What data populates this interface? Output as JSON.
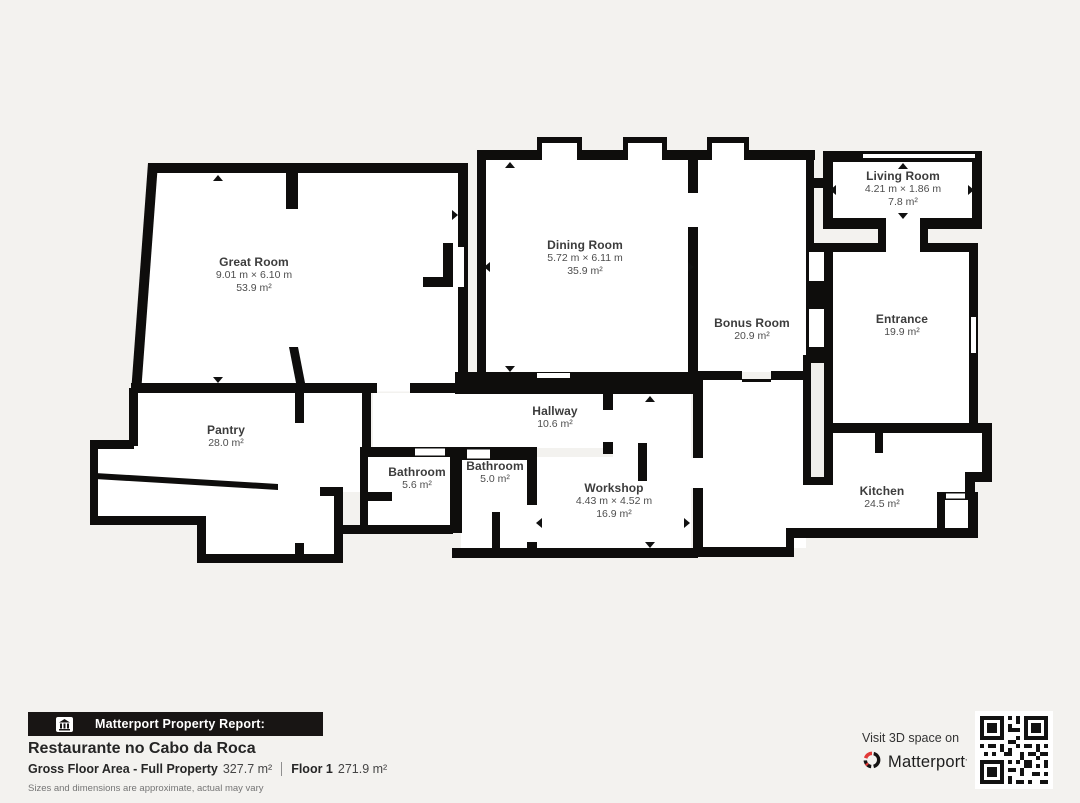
{
  "plan": {
    "rooms": [
      {
        "id": "great-room",
        "name": "Great Room",
        "dimensions": "9.01 m × 6.10 m",
        "area": "53.9 m²"
      },
      {
        "id": "dining-room",
        "name": "Dining Room",
        "dimensions": "5.72 m × 6.11 m",
        "area": "35.9 m²"
      },
      {
        "id": "living-room",
        "name": "Living Room",
        "dimensions": "4.21 m × 1.86 m",
        "area": "7.8 m²"
      },
      {
        "id": "bonus-room",
        "name": "Bonus Room",
        "area": "20.9 m²"
      },
      {
        "id": "entrance",
        "name": "Entrance",
        "area": "19.9 m²"
      },
      {
        "id": "pantry",
        "name": "Pantry",
        "area": "28.0 m²"
      },
      {
        "id": "hallway",
        "name": "Hallway",
        "area": "10.6 m²"
      },
      {
        "id": "bathroom-1",
        "name": "Bathroom",
        "area": "5.6 m²"
      },
      {
        "id": "bathroom-2",
        "name": "Bathroom",
        "area": "5.0 m²"
      },
      {
        "id": "workshop",
        "name": "Workshop",
        "dimensions": "4.43 m × 4.52 m",
        "area": "16.9 m²"
      },
      {
        "id": "kitchen",
        "name": "Kitchen",
        "area": "24.5 m²"
      }
    ]
  },
  "footer": {
    "report_label": "Matterport Property Report:",
    "property_name": "Restaurante no Cabo da Roca",
    "gross_label": "Gross Floor Area - Full Property",
    "gross_value": "327.7 m²",
    "floor_label": "Floor 1",
    "floor_value": "271.9 m²",
    "disclaimer": "Sizes and dimensions are approximate, actual may vary",
    "visit_text": "Visit 3D space on",
    "brand": "Matterport",
    "brand_trademark": "’"
  },
  "colors": {
    "wall": "#0e0d0c",
    "background": "#f3f2ef",
    "room": "#ffffff",
    "brand_red": "#e13a38"
  }
}
